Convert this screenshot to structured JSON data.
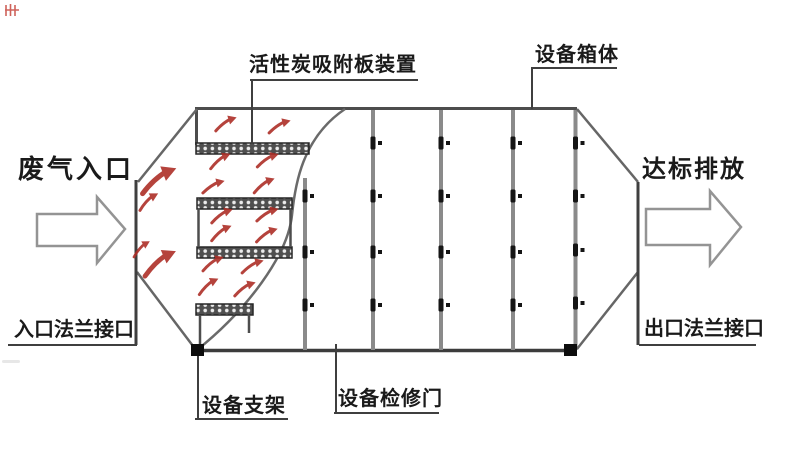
{
  "labels": {
    "waste_gas_inlet": "废气入口",
    "carbon_plate_device": "活性炭吸附板装置",
    "equipment_housing": "设备箱体",
    "compliant_discharge": "达标排放",
    "inlet_flange": "入口法兰接口",
    "outlet_flange": "出口法兰接口",
    "equipment_support": "设备支架",
    "access_door": "设备检修门"
  },
  "colors": {
    "outline": "#4d4d4d",
    "panel_divider": "#8a8a8a",
    "leader_line": "#3f3f3f",
    "carbon_plate": "#4f4f4f",
    "flow_arrow_red": "#ad2f28",
    "hinge_black": "#151515",
    "text": "#1a1a1a",
    "background": "#ffffff",
    "watermark_red": "#c43b32"
  }
}
